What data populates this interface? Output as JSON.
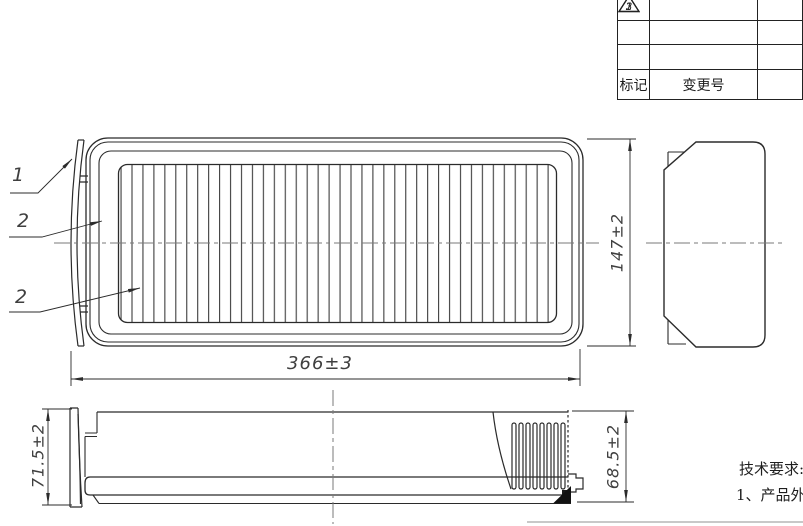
{
  "revision_table": {
    "rows": [
      {
        "symbol": "3",
        "change_no": ""
      },
      {
        "symbol": "2",
        "change_no": ""
      },
      {
        "symbol": "1",
        "change_no": ""
      }
    ],
    "mark_header": "标记",
    "change_no_header": "变更号"
  },
  "callouts": {
    "seal": "1",
    "frame": "2",
    "media": "2"
  },
  "dimensions": {
    "overall_length": "366±3",
    "overall_width": "147±2",
    "left_height": "71.5±2",
    "right_height": "68.5±2"
  },
  "technical_notes": {
    "title": "技术要求:",
    "item1": "1、产品外观"
  },
  "colors": {
    "line": "#2b2b2b",
    "dimension": "#3a3a3a",
    "centerline": "#7a7a7a",
    "footer_rule": "#b5b5b5"
  }
}
